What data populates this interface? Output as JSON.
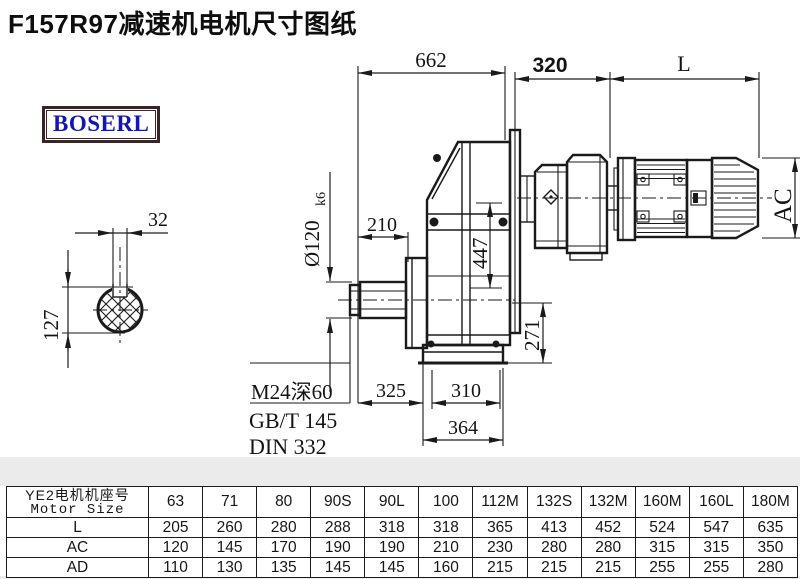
{
  "page": {
    "title": "F157R97减速机电机尺寸图纸",
    "logo": "BOSERL"
  },
  "drawing": {
    "dims": {
      "d662": "662",
      "d320": "320",
      "dL": "L",
      "d32": "32",
      "d127": "127",
      "dia_text": "Ø120",
      "dia_tol": "k6",
      "d210": "210",
      "d447": "447",
      "d271": "271",
      "d325": "325",
      "d310": "310",
      "d364": "364",
      "dAC": "AC"
    },
    "callout": {
      "line1": "M24深60",
      "line2": "GB/T 145",
      "line3": "DIN 332"
    }
  },
  "table": {
    "header": {
      "line1": "YE2电机机座号",
      "line2": "Motor Size"
    },
    "columns": [
      "63",
      "71",
      "80",
      "90S",
      "90L",
      "100",
      "112M",
      "132S",
      "132M",
      "160M",
      "160L",
      "180M"
    ],
    "rows": [
      {
        "label": "L",
        "values": [
          "205",
          "260",
          "280",
          "288",
          "318",
          "318",
          "365",
          "413",
          "452",
          "524",
          "547",
          "635"
        ]
      },
      {
        "label": "AC",
        "values": [
          "120",
          "145",
          "170",
          "190",
          "190",
          "210",
          "230",
          "280",
          "280",
          "315",
          "315",
          "350"
        ]
      },
      {
        "label": "AD",
        "values": [
          "110",
          "130",
          "135",
          "145",
          "145",
          "160",
          "215",
          "215",
          "215",
          "255",
          "255",
          "280"
        ]
      }
    ]
  }
}
